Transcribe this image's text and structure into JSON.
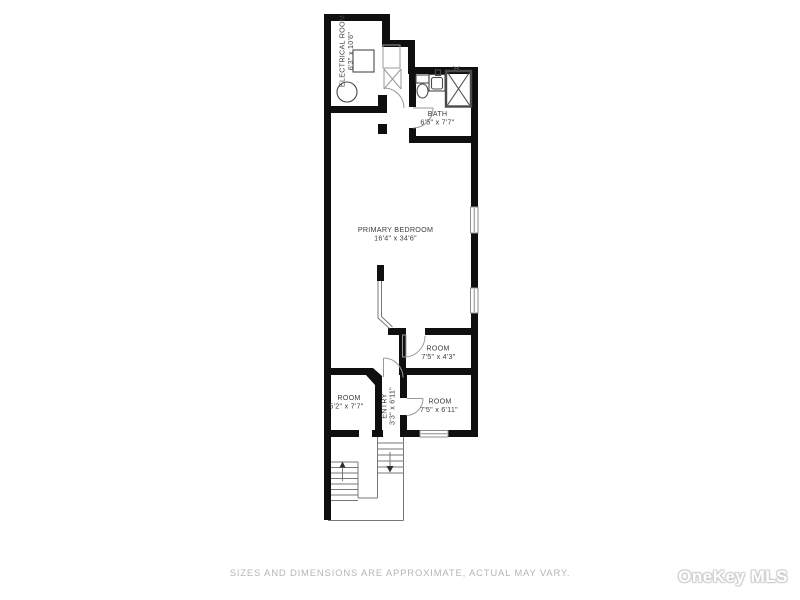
{
  "plan": {
    "rooms": {
      "electrical_room": {
        "label": "ELECTRICAL ROOM",
        "dims": "6'3\" x 10'6\""
      },
      "bath": {
        "label": "BATH",
        "dims": "6'5\" x 7'7\""
      },
      "primary_bedroom": {
        "label": "PRIMARY BEDROOM",
        "dims": "16'4\" x 34'6\""
      },
      "room_center": {
        "label": "ROOM",
        "dims": "7'5\" x 4'3\""
      },
      "room_left": {
        "label": "ROOM",
        "dims": "5'2\" x 7'7\""
      },
      "entry": {
        "label": "ENTRY",
        "dims": "3'3\" x 6'11\""
      },
      "room_right": {
        "label": "ROOM",
        "dims": "7'5\" x 6'11\""
      }
    },
    "colors": {
      "wall": "#0f0f0f",
      "thin_line": "#777777",
      "door_line": "#999999",
      "label_text": "#3c3c3c",
      "disclaimer_text": "#b6b6b6",
      "watermark_fill": "#ffffff",
      "watermark_outline": "#cccccc"
    }
  },
  "footer": {
    "disclaimer": "SIZES AND DIMENSIONS ARE APPROXIMATE, ACTUAL MAY VARY."
  },
  "watermark": {
    "brand": "OneKey MLS"
  }
}
